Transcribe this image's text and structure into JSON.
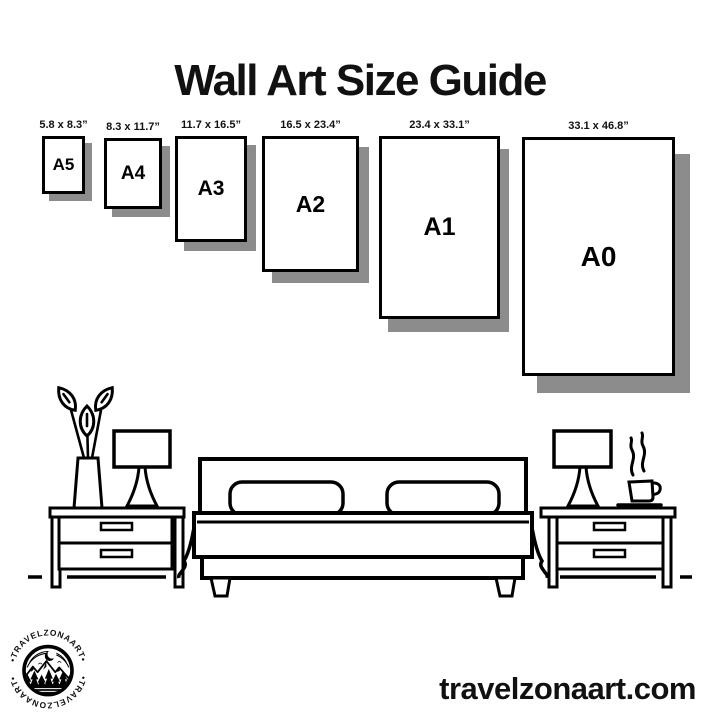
{
  "title": "Wall Art Size Guide",
  "sizes": [
    {
      "label": "A5",
      "dimensions": "5.8 x 8.3”"
    },
    {
      "label": "A4",
      "dimensions": "8.3 x 11.7”"
    },
    {
      "label": "A3",
      "dimensions": "11.7 x 16.5”"
    },
    {
      "label": "A2",
      "dimensions": "16.5 x 23.4”"
    },
    {
      "label": "A1",
      "dimensions": "23.4 x 33.1”"
    },
    {
      "label": "A0",
      "dimensions": "33.1 x 46.8”"
    }
  ],
  "illustration": {
    "items": [
      "plant-vase",
      "table-lamp-left",
      "nightstand-left",
      "bed-with-pillows",
      "nightstand-right",
      "table-lamp-right",
      "coffee-cup"
    ]
  },
  "logo": {
    "text_top": "•TRAVELZONAART•",
    "text_bottom": "•TRAVELZONAART•"
  },
  "footer": {
    "website": "travelzonaart.com"
  },
  "colors": {
    "ink": "#000000",
    "frame_shadow": "#8c8c8c",
    "background": "#ffffff"
  }
}
